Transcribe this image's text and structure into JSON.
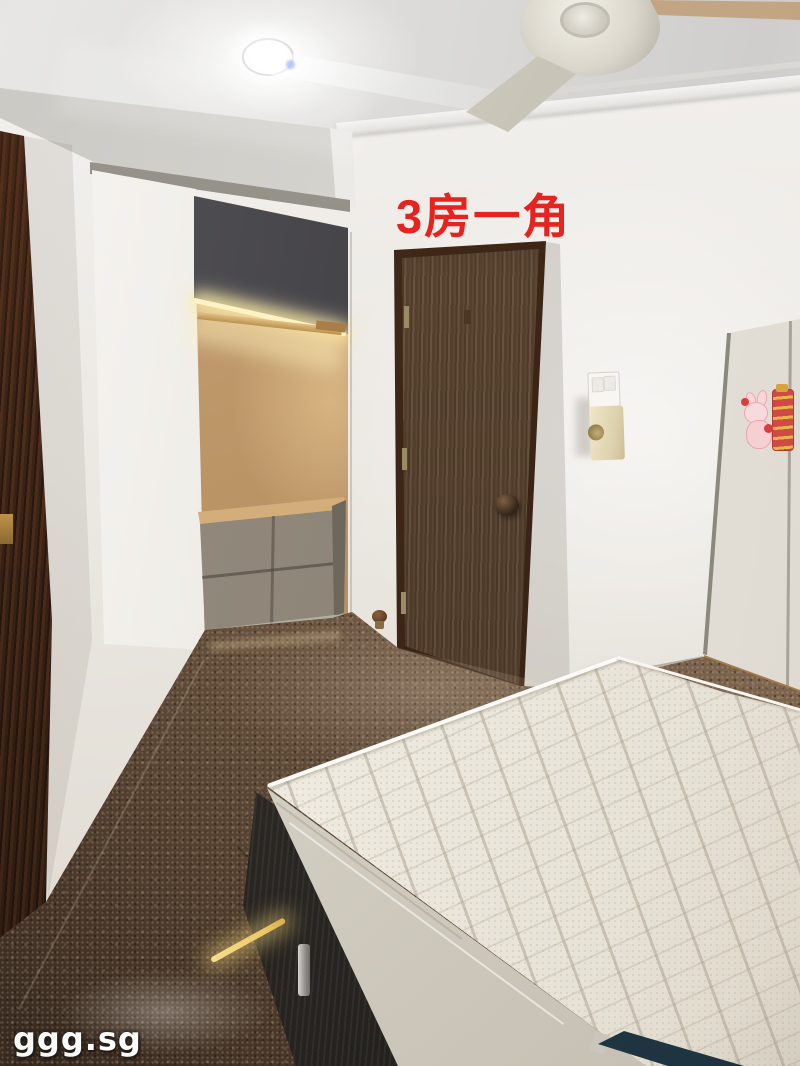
{
  "photo": {
    "subject": "rental-listing bedroom photo: open wardrobe, dark wooden door, white quilted mattress on dark bed frame, granite floor",
    "overlays": {
      "caption": {
        "text": "3房一角",
        "color": "#e6231e"
      },
      "watermark": {
        "text": "ggg.sg",
        "color": "#ffffff"
      }
    }
  },
  "palette": {
    "wall": "#ece9e3",
    "door_wood": "#5d4835",
    "door_frame": "#3a2415",
    "closet_top": "#3d3c40",
    "closet_back": "#c9a476",
    "drawer_front": "#877e72",
    "floor_light": "#a18769",
    "floor_dark": "#6b543f",
    "mattress": "#f1eee7",
    "bed_frame": "#2b2824",
    "led": "#fff3c4",
    "cabinet": "#f0ede7",
    "sticker_pink": "#f8dadc",
    "tag_navy": "#1d323e",
    "caption_red": "#e6231e",
    "watermark_white": "#ffffff"
  }
}
